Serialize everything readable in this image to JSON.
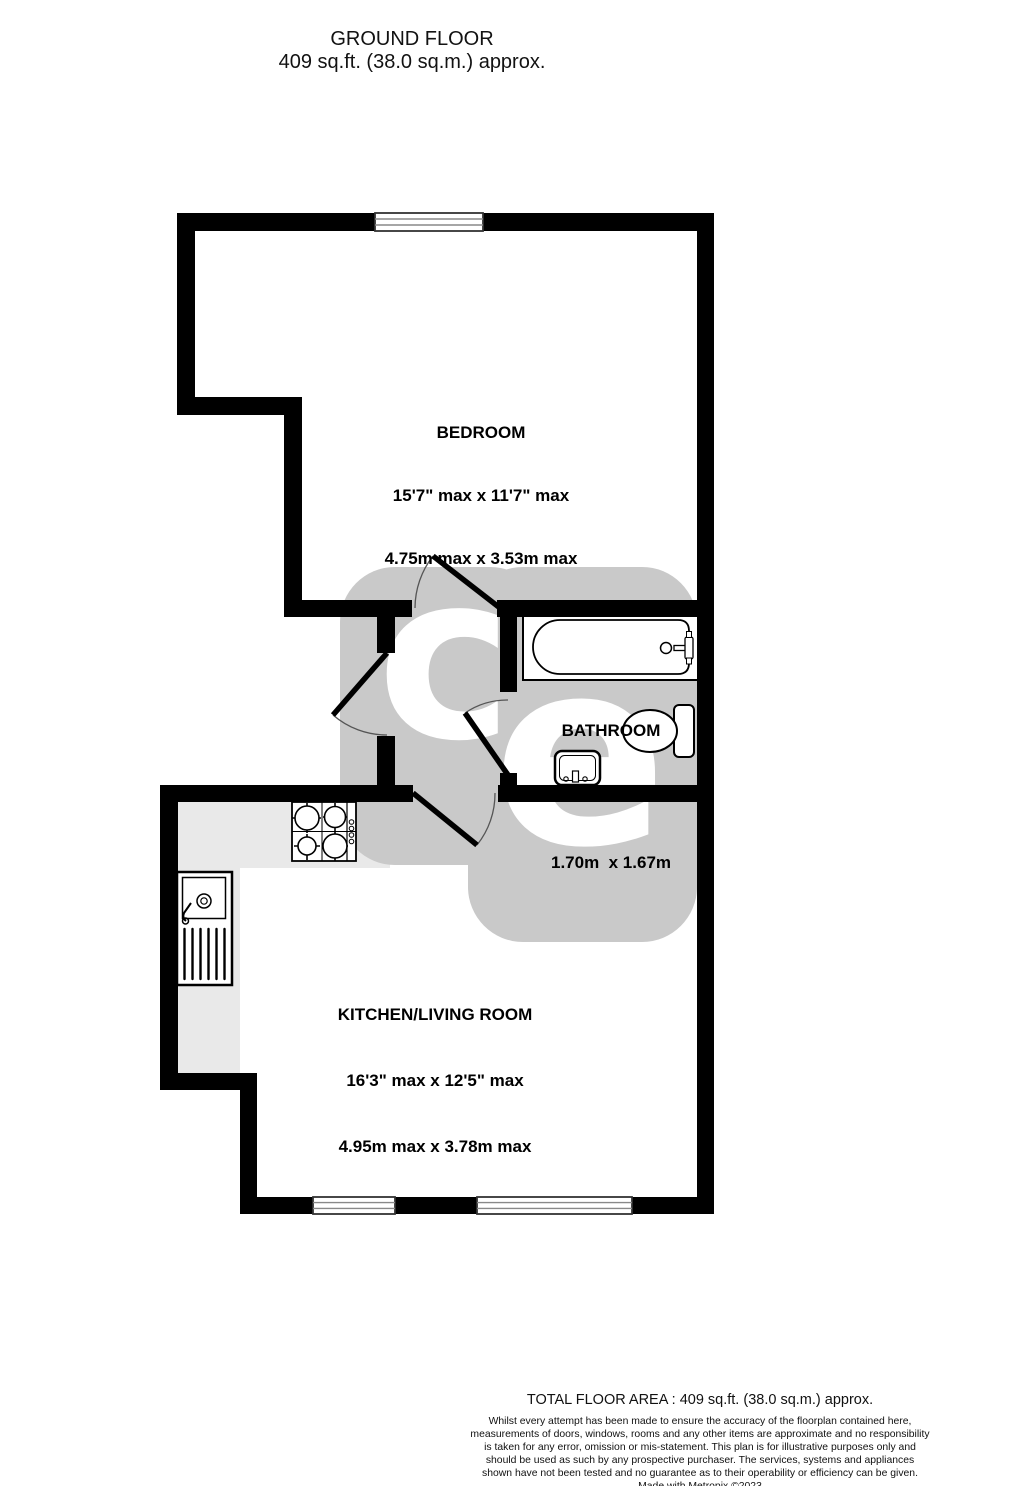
{
  "title": {
    "line1": "GROUND FLOOR",
    "line2": "409 sq.ft. (38.0 sq.m.) approx."
  },
  "rooms": {
    "bedroom": {
      "name": "BEDROOM",
      "dims_imperial": "15'7\" max x 11'7\" max",
      "dims_metric": "4.75m max x 3.53m max"
    },
    "bathroom": {
      "name": "BATHROOM",
      "dims_imperial": "5'7\"  x 5'6\"",
      "dims_metric": "1.70m  x 1.67m"
    },
    "kitchen_living": {
      "name": "KITCHEN/LIVING ROOM",
      "dims_imperial": "16'3\" max x 12'5\" max",
      "dims_metric": "4.95m max x 3.78m max"
    }
  },
  "footer": {
    "total_area": "TOTAL FLOOR AREA : 409 sq.ft. (38.0 sq.m.) approx.",
    "disclaimer": "Whilst every attempt has been made to ensure the accuracy of the floorplan contained here, measurements of doors, windows, rooms and any other items are approximate and no responsibility is taken for any error, omission or mis-statement. This plan is for illustrative purposes only and should be used as such by any prospective purchaser. The services, systems and appliances shown have not been tested and no guarantee as to their operability or efficiency can be given.",
    "credit": "Made with Metropix ©2023"
  },
  "watermark": {
    "letter_left": "c",
    "letter_right": "e"
  },
  "colors": {
    "wall": "#000000",
    "counter": "#e9e9e9",
    "watermark": "#c9c9c9",
    "background": "#ffffff",
    "text": "#000000"
  }
}
